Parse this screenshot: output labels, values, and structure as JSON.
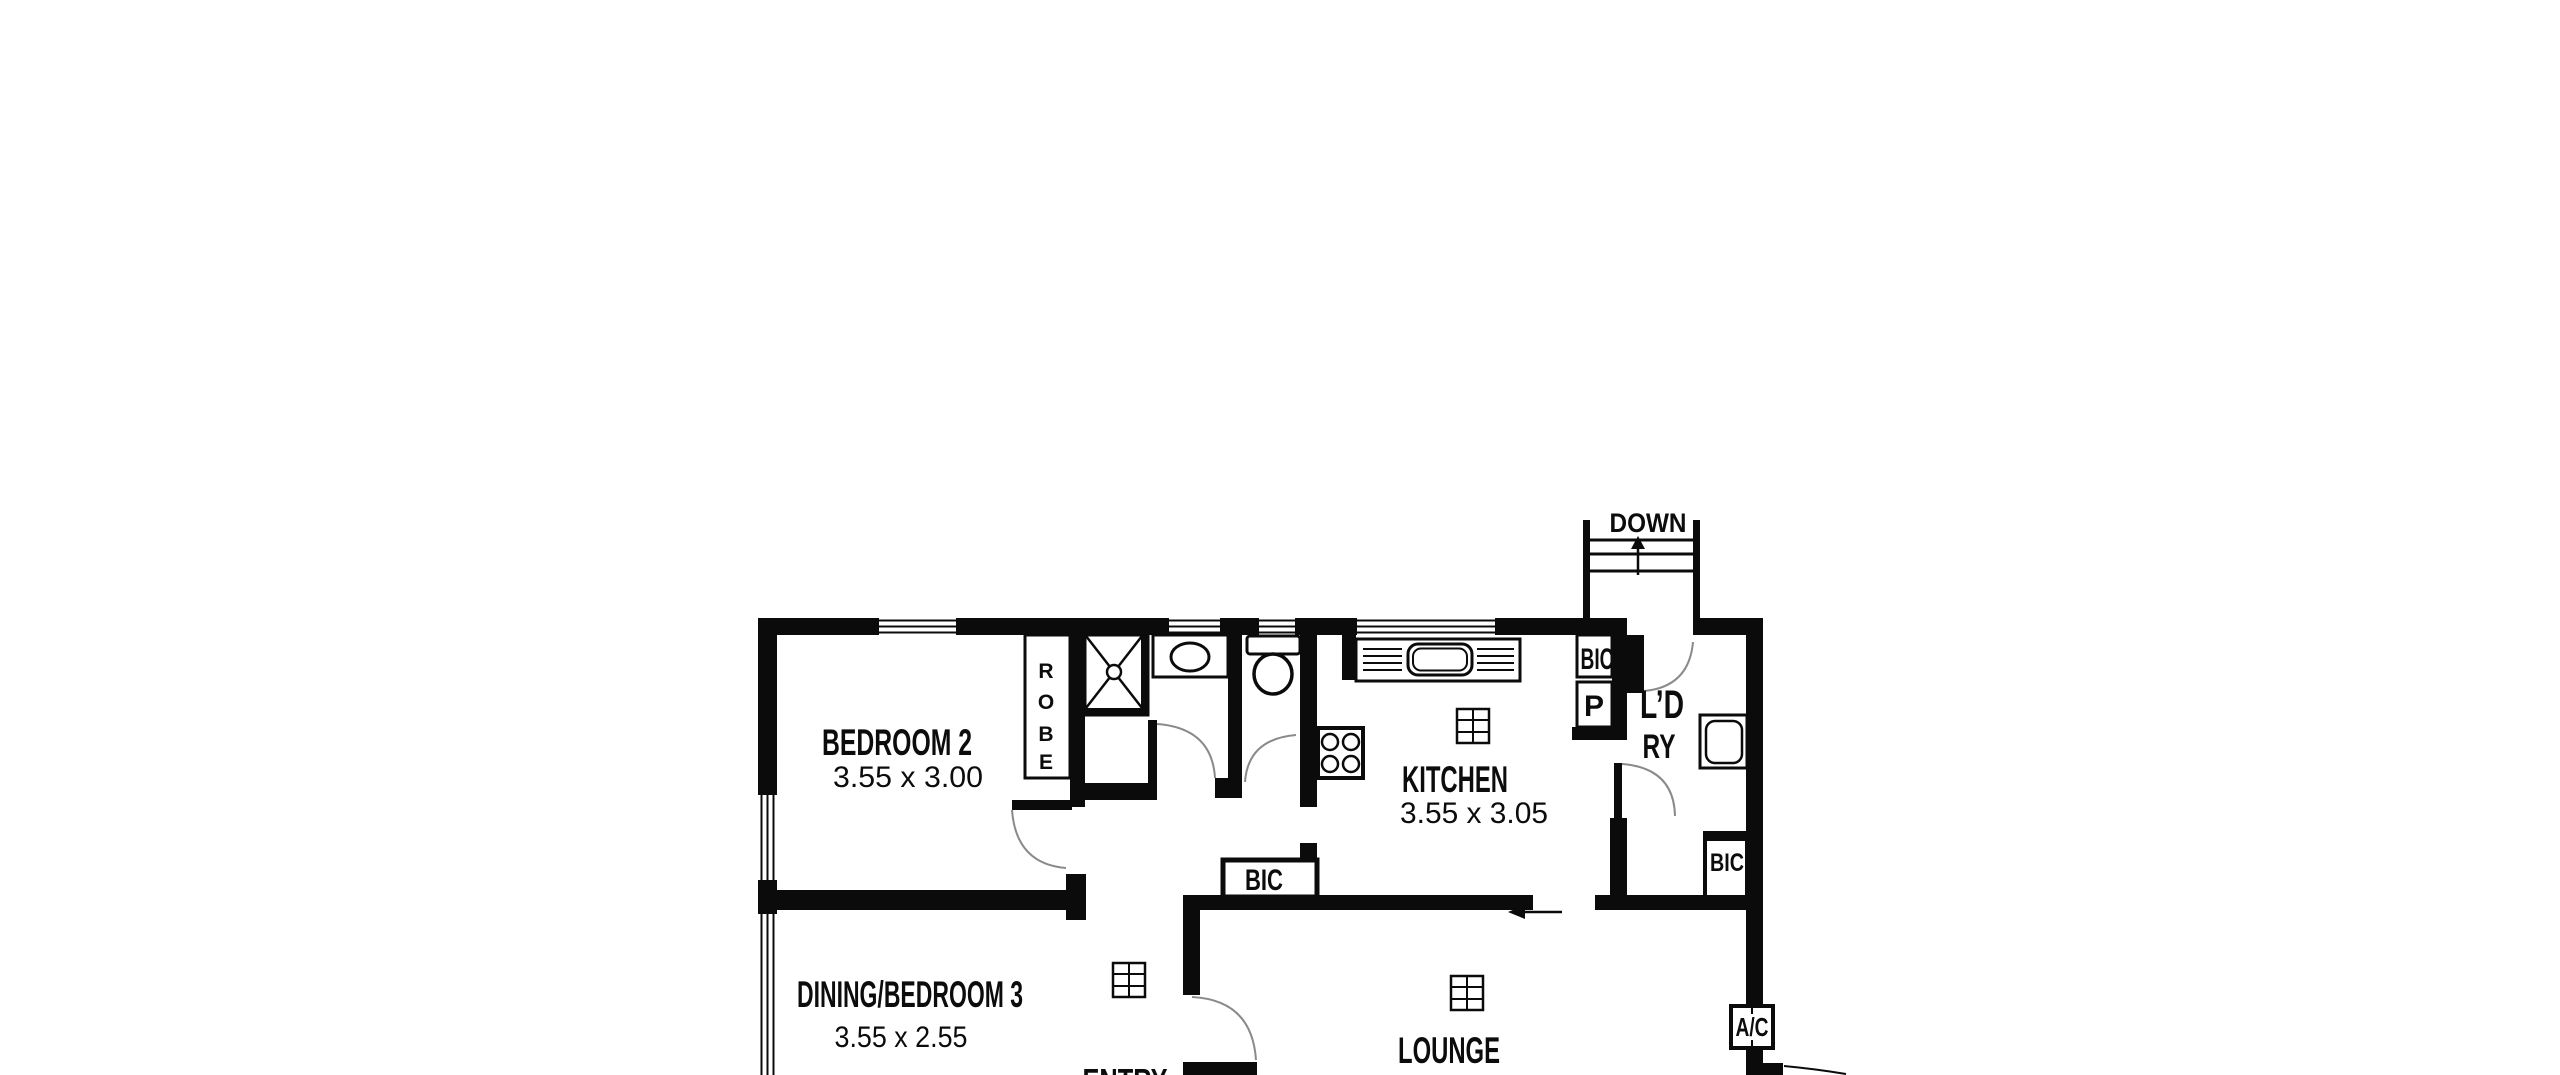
{
  "rooms": {
    "bedroom2": {
      "name": "BEDROOM 2",
      "dims": "3.55 x 3.00"
    },
    "dining_bedroom3": {
      "name": "DINING/BEDROOM 3",
      "dims": "3.55 x 2.55"
    },
    "kitchen": {
      "name": "KITCHEN",
      "dims": "3.55 x 3.05"
    },
    "lounge": {
      "name": "LOUNGE"
    },
    "laundry": {
      "name_line1": "L’D",
      "name_line2": "RY"
    },
    "entry": {
      "name": "ENTRY"
    }
  },
  "labels": {
    "stairs_down": "DOWN",
    "robe_letters": [
      "R",
      "O",
      "B",
      "E"
    ],
    "kitchen_bic": "BIC",
    "hall_bic": "BIC",
    "lounge_bic": "BIC",
    "pantry": "P",
    "air_conditioner": "A/C"
  },
  "icons": {
    "fixtures": [
      "shower-icon",
      "vanity-basin-icon",
      "toilet-icon",
      "kitchen-sink-icon",
      "stove-icon",
      "laundry-tub-icon",
      "heater-vent-icon",
      "stairs-icon",
      "door-swing-arc",
      "window",
      "air-conditioner-unit"
    ]
  },
  "colors": {
    "walls": "#0b0b0b",
    "background": "#ffffff",
    "door_arc": "#8a8a8a",
    "fixture_fill": "#c7c7c7"
  }
}
